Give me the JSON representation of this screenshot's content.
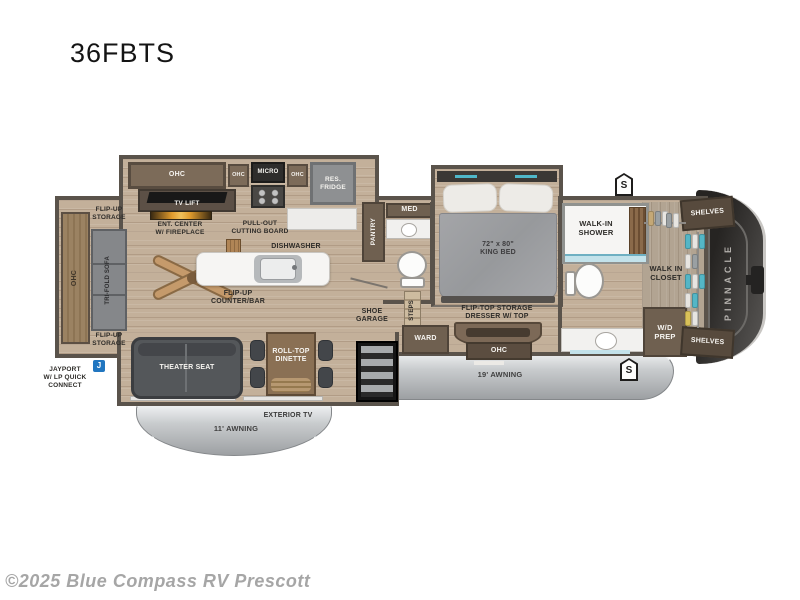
{
  "title": "36FBTS",
  "copyright": "©2025 Blue Compass RV Prescott",
  "brand_vertical": "PINNACLE",
  "colors": {
    "wall": "#5a534b",
    "floor_wood": "#c3b09a",
    "awning_gray": "#aeb1b4",
    "accent_teal": "#4fb7c9",
    "front_cap_dark": "#2e2c2a",
    "jayport_blue": "#2176c0"
  },
  "badges": {
    "s_badge": "S",
    "jayport_icon": "J"
  },
  "labels": {
    "ohc": "OHC",
    "micro": "MICRO",
    "res_fridge": "RES.\nFRIDGE",
    "tv_lift": "TV LIFT",
    "ent_center": "ENT. CENTER\nW/ FIREPLACE",
    "pull_out_cutting_board": "PULL-OUT\nCUTTING BOARD",
    "dishwasher": "DISHWASHER",
    "flip_up_counter_bar": "FLIP-UP\nCOUNTER/BAR",
    "pantry": "PANTRY",
    "med": "MED",
    "flip_up_storage": "FLIP-UP\nSTORAGE",
    "tri_fold_sofa": "TRI-FOLD SOFA",
    "jayport": "JAYPORT\nW/ LP QUICK\nCONNECT",
    "theater_seat": "THEATER SEAT",
    "roll_top_dinette": "ROLL-TOP\nDINETTE",
    "exterior_tv": "EXTERIOR TV",
    "awning_11": "11' AWNING",
    "awning_19": "19' AWNING",
    "shoe_garage": "SHOE\nGARAGE",
    "steps": "STEPS",
    "ward": "WARD",
    "king_bed": "72\" x 80\"\nKING BED",
    "flip_top_dresser": "FLIP-TOP STORAGE\nDRESSER W/ TOP",
    "walk_in_shower": "WALK-IN\nSHOWER",
    "walk_in_closet": "WALK IN\nCLOSET",
    "wd_prep": "W/D\nPREP",
    "shelves": "SHELVES"
  }
}
